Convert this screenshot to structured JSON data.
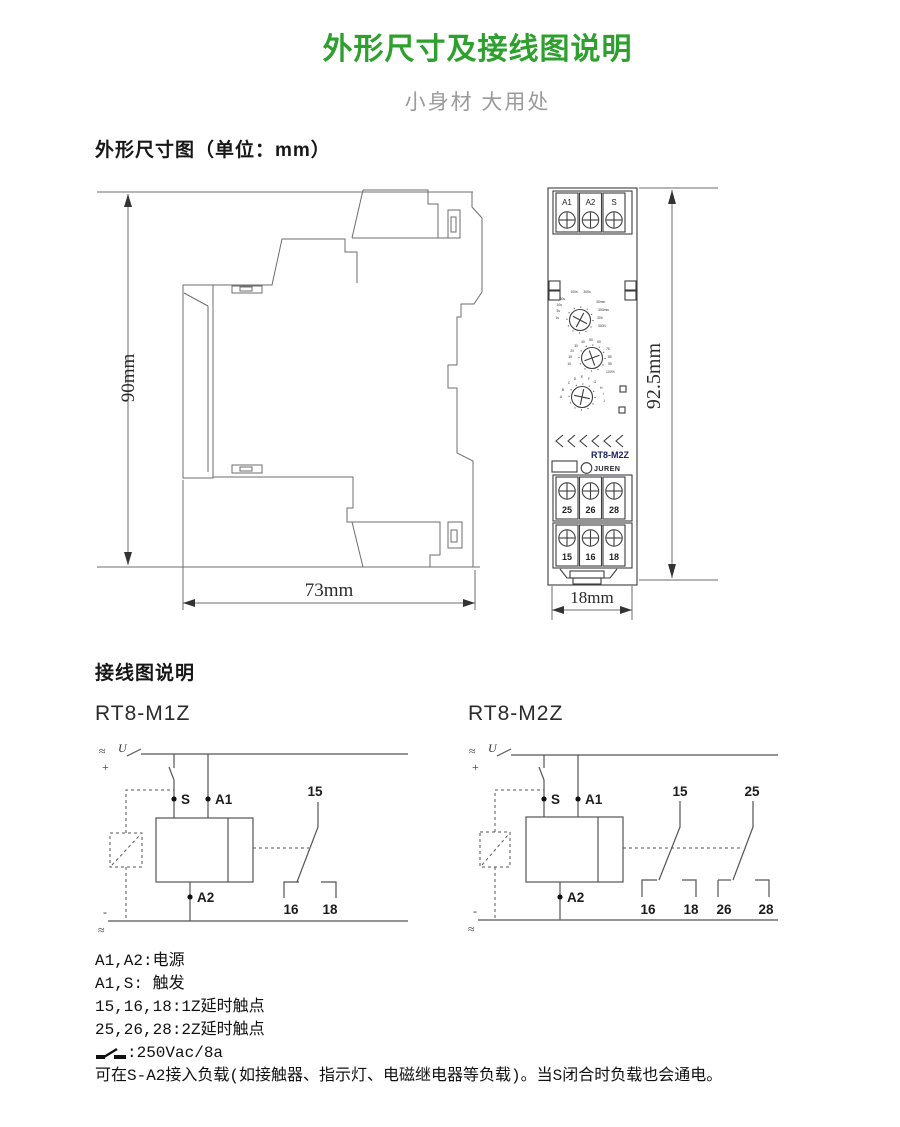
{
  "header": {
    "title": "外形尺寸及接线图说明",
    "subtitle": "小身材 大用处"
  },
  "sections": {
    "dimensions_heading": "外形尺寸图（单位：mm）",
    "wiring_heading": "接线图说明"
  },
  "side_view": {
    "height_label": "90mm",
    "width_label": "73mm"
  },
  "front_view": {
    "height_label": "92.5mm",
    "width_label": "18mm",
    "top_terminals": [
      "A1",
      "A2",
      "S"
    ],
    "mid_terminals": [
      "25",
      "26",
      "28"
    ],
    "bottom_terminals": [
      "15",
      "16",
      "18"
    ],
    "model_label": "RT8-M2Z",
    "brand": "JUREN",
    "brand_initial": "R",
    "knob1_labels": [
      "1s",
      "3s",
      "10s",
      "30s",
      "100s",
      "300s",
      "30min",
      "300min",
      "30h",
      "300h"
    ],
    "knob2_labels": [
      "10",
      "15",
      "20",
      "30",
      "40",
      "50",
      "60",
      "75",
      "85",
      "95",
      "100%"
    ],
    "knob3_labels": [
      "A",
      "B",
      "C",
      "D",
      "E",
      "F",
      "G",
      "H",
      "I",
      "J"
    ],
    "colors": {
      "knob_green": "#00A551",
      "led_green": "#00A33C",
      "led_red": "#E60012",
      "logo_orange": "#E65520",
      "model_navy": "#1A1F5C",
      "title_green": "#2DA02D"
    }
  },
  "wiring": {
    "m1z": {
      "title": "RT8-M1Z",
      "ac_top": "≈",
      "u": "U",
      "plus": "+",
      "minus": "-",
      "ac_bottom": "≈",
      "s": "S",
      "a1": "A1",
      "a2": "A2",
      "c15": "15",
      "c16": "16",
      "c18": "18"
    },
    "m2z": {
      "title": "RT8-M2Z",
      "ac_top": "≈",
      "u": "U",
      "plus": "+",
      "minus": "-",
      "ac_bottom": "≈",
      "s": "S",
      "a1": "A1",
      "a2": "A2",
      "c15": "15",
      "c16": "16",
      "c18": "18",
      "c25": "25",
      "c26": "26",
      "c28": "28"
    }
  },
  "notes": {
    "line1": "A1,A2:电源",
    "line2": "A1,S: 触发",
    "line3": "15,16,18:1Z延时触点",
    "line4": "25,26,28:2Z延时触点",
    "line5": ":250Vac/8a",
    "line6": "可在S-A2接入负载(如接触器、指示灯、电磁继电器等负载)。当S闭合时负载也会通电。"
  }
}
